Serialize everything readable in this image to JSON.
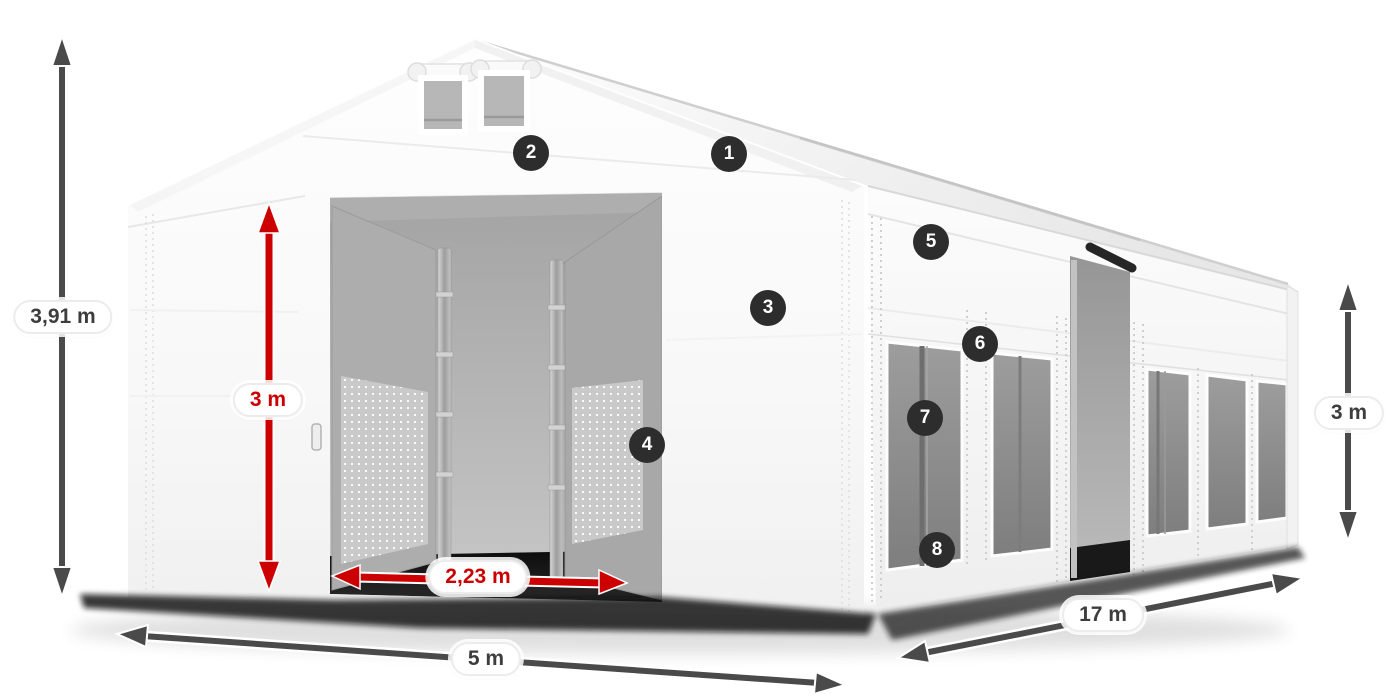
{
  "dimensions": {
    "total_height": "3,91 m",
    "entrance_height": "3 m",
    "entrance_width": "2,23 m",
    "width": "5 m",
    "length": "17 m",
    "side_wall_height": "3 m"
  },
  "markers": [
    {
      "n": "1"
    },
    {
      "n": "2"
    },
    {
      "n": "3"
    },
    {
      "n": "4"
    },
    {
      "n": "5"
    },
    {
      "n": "6"
    },
    {
      "n": "7"
    },
    {
      "n": "8"
    }
  ],
  "colors": {
    "background": "#ffffff",
    "dimension_arrow_dark": "#4a4a4a",
    "dimension_arrow_red": "#cc0000",
    "label_background": "#ffffff",
    "label_text_dark": "#3d3d3d",
    "label_text_red": "#cc0000",
    "marker_background": "#2d2d2d",
    "marker_text": "#ffffff"
  }
}
